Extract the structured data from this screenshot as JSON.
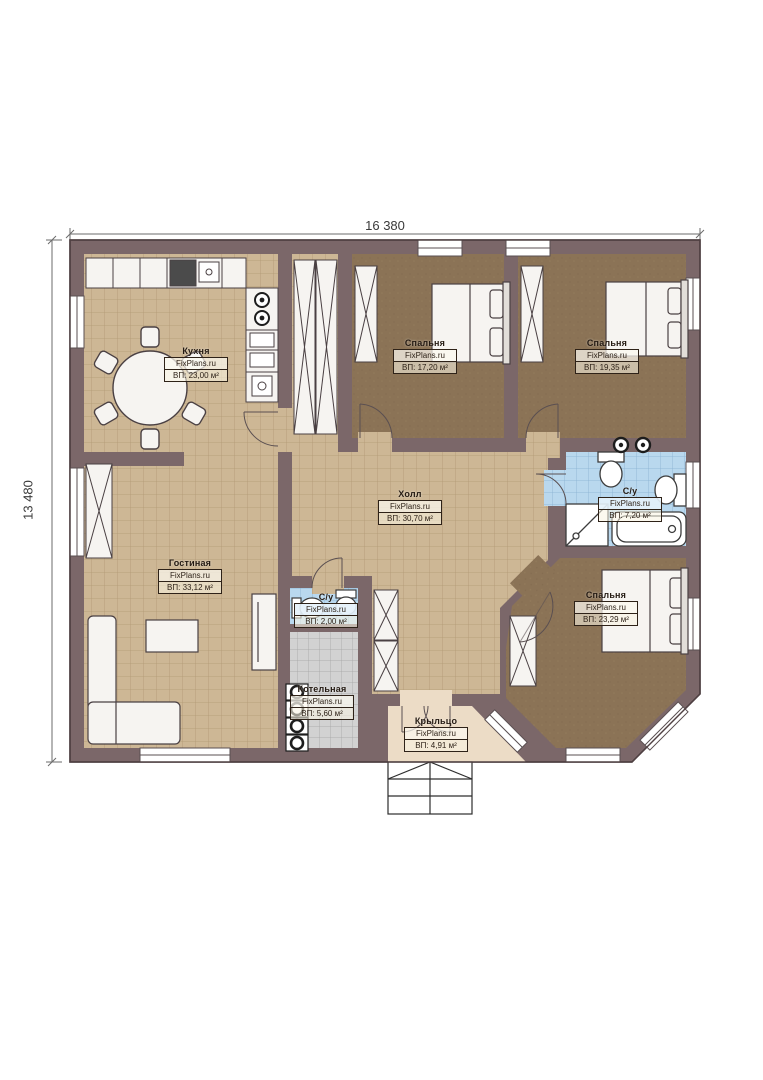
{
  "title": "Floor plan",
  "dimensions": {
    "width_label": "16 380",
    "height_label": "13 480"
  },
  "branding": {
    "watermark": "FixPlans.ru"
  },
  "rooms": [
    {
      "id": "kitchen",
      "name": "Кухня",
      "brand": "FixPlans.ru",
      "area": "ВП: 23,00 м²"
    },
    {
      "id": "bedroom-1",
      "name": "Спальня",
      "brand": "FixPlans.ru",
      "area": "ВП: 17,20 м²"
    },
    {
      "id": "bedroom-2",
      "name": "Спальня",
      "brand": "FixPlans.ru",
      "area": "ВП: 19,35 м²"
    },
    {
      "id": "hall",
      "name": "Холл",
      "brand": "FixPlans.ru",
      "area": "ВП: 30,70 м²"
    },
    {
      "id": "bathroom",
      "name": "С/у",
      "brand": "FixPlans.ru",
      "area": "ВП: 7,20 м²"
    },
    {
      "id": "living",
      "name": "Гостиная",
      "brand": "FixPlans.ru",
      "area": "ВП: 33,12 м²"
    },
    {
      "id": "wc-small",
      "name": "С/у",
      "brand": "FixPlans.ru",
      "area": "ВП: 2,00 м²"
    },
    {
      "id": "boiler",
      "name": "Котельная",
      "brand": "FixPlans.ru",
      "area": "ВП: 5,60 м²"
    },
    {
      "id": "bedroom-3",
      "name": "Спальня",
      "brand": "FixPlans.ru",
      "area": "ВП: 23,29 м²"
    },
    {
      "id": "porch",
      "name": "Крыльцо",
      "brand": "FixPlans.ru",
      "area": "ВП: 4,91 м²"
    }
  ],
  "colors": {
    "wall": "#7b6769",
    "wall_outline": "#4f4042",
    "floor_tile_beige": "#cdb795",
    "floor_bedroom_brown": "#8b7356",
    "floor_tile_blue": "#b9d8ee",
    "floor_tile_gray": "#d2d2d2",
    "floor_porch": "#ecdcc6",
    "furniture_fill": "#f6f4f1",
    "line": "#4a4043"
  }
}
